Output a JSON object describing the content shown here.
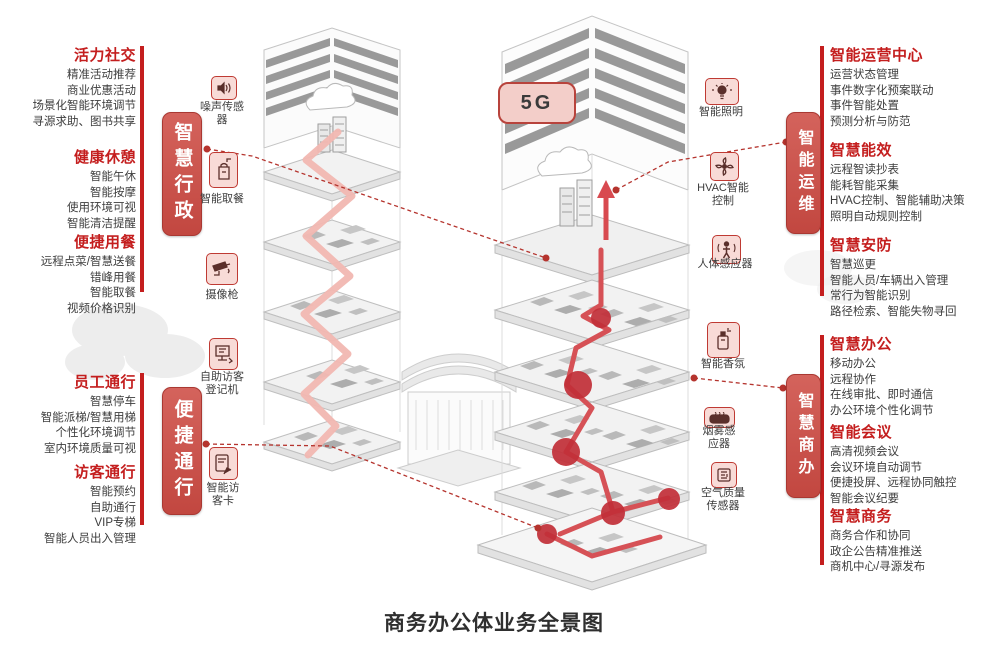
{
  "page": {
    "title": "商务办公体业务全景图",
    "badge_5g": "5G"
  },
  "pills": {
    "admin": "智慧行政",
    "access": "便捷通行",
    "ops": "智能运维",
    "business": "智慧商办"
  },
  "left_sections": [
    {
      "heading": "活力社交",
      "items": [
        "精准活动推荐",
        "商业优惠活动",
        "场景化智能环境调节",
        "寻源求助、图书共享"
      ]
    },
    {
      "heading": "健康休憩",
      "items": [
        "智能午休",
        "智能按摩",
        "使用环境可视",
        "智能清洁提醒"
      ]
    },
    {
      "heading": "便捷用餐",
      "items": [
        "远程点菜/智慧送餐",
        "错峰用餐",
        "智能取餐",
        "视频价格识别"
      ]
    },
    {
      "heading": "员工通行",
      "items": [
        "智慧停车",
        "智能派梯/智慧用梯",
        "个性化环境调节",
        "室内环境质量可视"
      ]
    },
    {
      "heading": "访客通行",
      "items": [
        "智能预约",
        "自助通行",
        "VIP专梯",
        "智能人员出入管理"
      ]
    }
  ],
  "right_sections": [
    {
      "heading": "智能运营中心",
      "items": [
        "运营状态管理",
        "事件数字化预案联动",
        "事件智能处置",
        "预测分析与防范"
      ]
    },
    {
      "heading": "智慧能效",
      "items": [
        "远程智读抄表",
        "能耗智能采集",
        "HVAC控制、智能辅助决策",
        "照明自动规则控制"
      ]
    },
    {
      "heading": "智慧安防",
      "items": [
        "智慧巡更",
        "智能人员/车辆出入管理",
        "常行为智能识别",
        "路径检索、智能失物寻回"
      ]
    },
    {
      "heading": "智慧办公",
      "items": [
        "移动办公",
        "远程协作",
        "在线审批、即时通信",
        "办公环境个性化调节"
      ]
    },
    {
      "heading": "智能会议",
      "items": [
        "高清视频会议",
        "会议环境自动调节",
        "便捷投屏、远程协同触控",
        "智能会议纪要"
      ]
    },
    {
      "heading": "智慧商务",
      "items": [
        "商务合作和协同",
        "政企公告精准推送",
        "商机中心/寻源发布"
      ]
    }
  ],
  "left_icons": [
    {
      "icon": "noise-sensor",
      "label": "噪声传感器"
    },
    {
      "icon": "meal-pickup",
      "label": "智能取餐"
    },
    {
      "icon": "cctv-camera",
      "label": "摄像枪"
    },
    {
      "icon": "visitor-kiosk",
      "label": "自助访客登记机"
    },
    {
      "icon": "visitor-card",
      "label": "智能访客卡"
    }
  ],
  "right_icons": [
    {
      "icon": "smart-lighting",
      "label": "智能照明"
    },
    {
      "icon": "hvac-control",
      "label": "HVAC智能控制"
    },
    {
      "icon": "body-sensor",
      "label": "人体感应器"
    },
    {
      "icon": "fragrance",
      "label": "智能香氛"
    },
    {
      "icon": "smoke-sensor",
      "label": "烟雾感应器"
    },
    {
      "icon": "air-quality-sensor",
      "label": "空气质量传感器"
    }
  ],
  "colors": {
    "accent_red": "#c41e1e",
    "pill_red": "#c9504a",
    "icon_bg": "#f8dbd7",
    "icon_border": "#bf3a33",
    "badge_bg": "#f3cec9",
    "path_pink": "#f1b7b1",
    "path_red": "#d65156",
    "node_red": "#c22f38",
    "text_dark": "#3d3d3d"
  }
}
